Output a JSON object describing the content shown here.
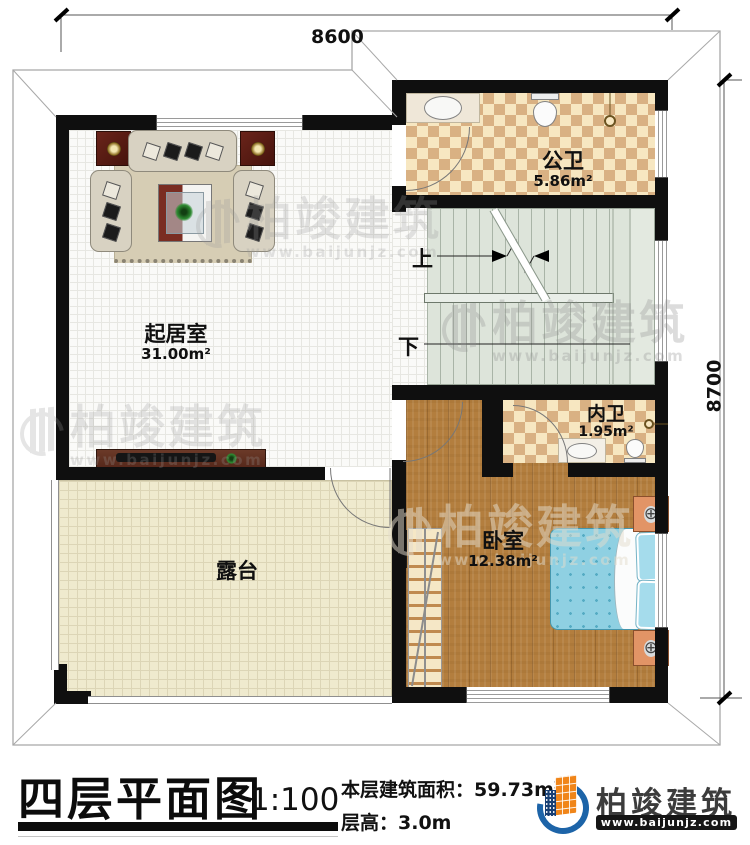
{
  "dims": {
    "top": "8600",
    "right": "8700"
  },
  "rooms": {
    "public_bath": {
      "name": "公卫",
      "area": "5.86m²"
    },
    "living": {
      "name": "起居室",
      "area": "31.00m²"
    },
    "inner_bath": {
      "name": "内卫",
      "area": "1.95m²"
    },
    "bedroom": {
      "name": "卧室",
      "area": "12.38m²"
    },
    "terrace": {
      "name": "露台"
    }
  },
  "stairs": {
    "up_label": "上",
    "down_label": "下"
  },
  "watermark": {
    "brand": "柏竣建筑",
    "url": "www.baijunjz.com"
  },
  "footer": {
    "title": "四层平面图",
    "scale": "1:100",
    "area_label": "本层建筑面积：",
    "area_value": "59.73m",
    "area_exp": "2",
    "floor_height_label": "层高：",
    "floor_height_value": "3.0m",
    "brand_name": "柏竣建筑",
    "brand_url": "www.baijunjz.com"
  },
  "colors": {
    "wall": "#0f0f0f",
    "checker_light": "#f7e7c1",
    "checker_dark": "#d9b183",
    "wood": "#b37e3e",
    "stair": "#dde4da",
    "terrace": "#efeace",
    "bed": "#8fd0e2",
    "brand_blue": "#1d64a8",
    "brand_orange": "#f08519"
  }
}
